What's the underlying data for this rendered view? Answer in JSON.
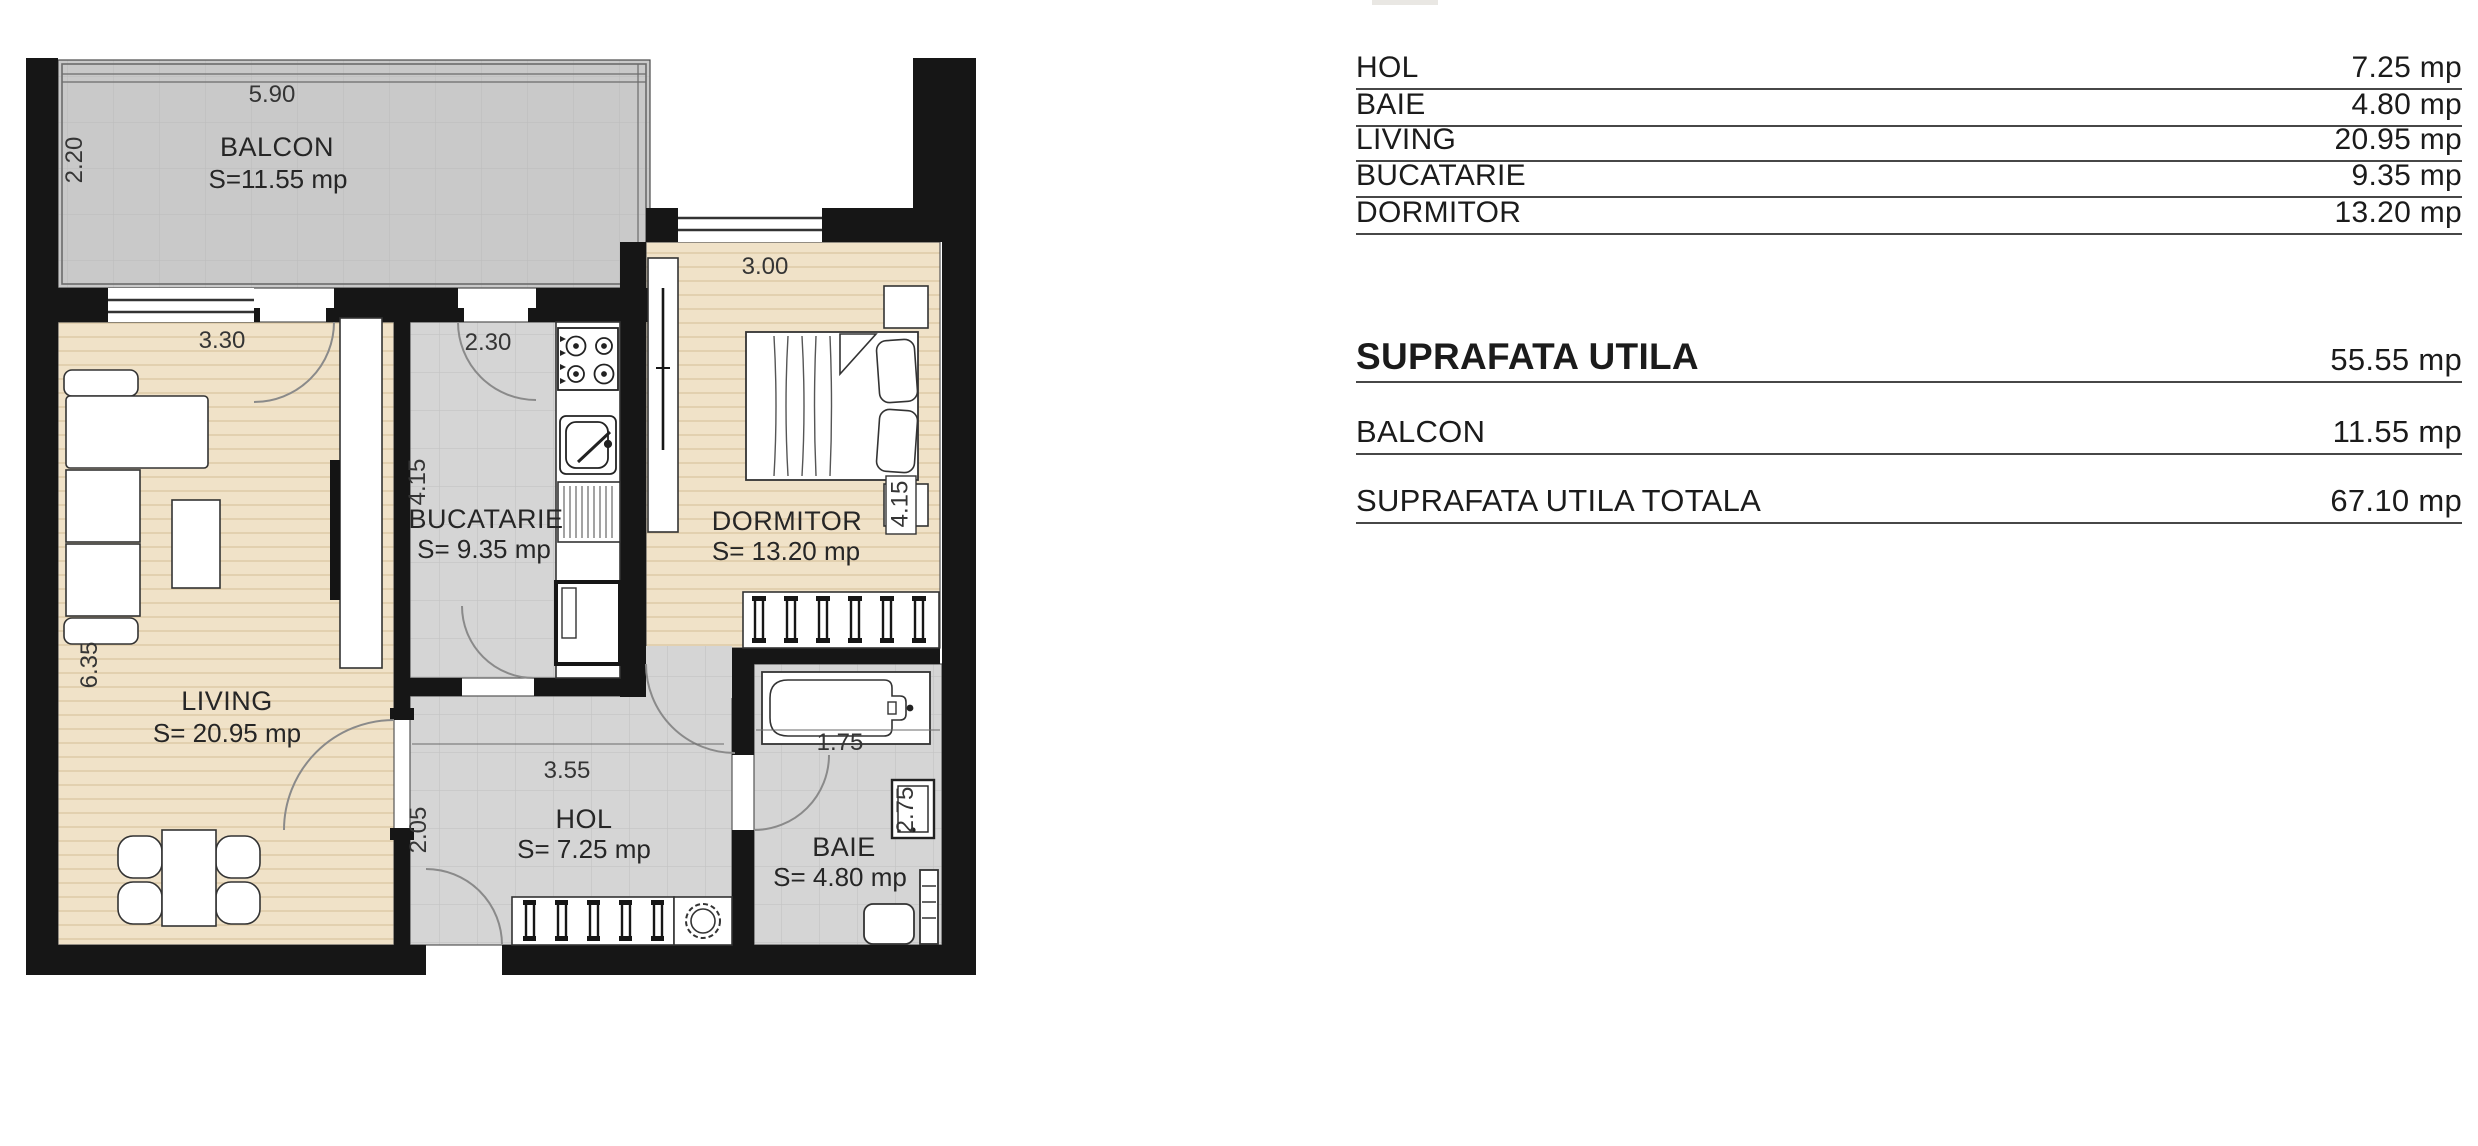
{
  "plan": {
    "rooms": {
      "balcon": {
        "name": "BALCON",
        "area": "S=11.55 mp",
        "dim_top": "5.90",
        "dim_left": "2.20"
      },
      "living": {
        "name": "LIVING",
        "area": "S= 20.95 mp",
        "dim_top": "3.30",
        "dim_left": "6.35"
      },
      "bucatarie": {
        "name": "BUCATARIE",
        "area": "S= 9.35 mp",
        "dim_top": "2.30",
        "dim_left": "4.15"
      },
      "dormitor": {
        "name": "DORMITOR",
        "area": "S= 13.20 mp",
        "dim_top": "3.00",
        "dim_right": "4.15"
      },
      "hol": {
        "name": "HOL",
        "area": "S= 7.25 mp",
        "dim_top": "3.55",
        "dim_left": "2.05"
      },
      "baie": {
        "name": "BAIE",
        "area": "S= 4.80 mp",
        "dim_top": "1.75",
        "dim_right": "2.75"
      }
    }
  },
  "table": {
    "rows": [
      {
        "label": "HOL",
        "value": "7.25 mp"
      },
      {
        "label": "BAIE",
        "value": "4.80 mp"
      },
      {
        "label": "LIVING",
        "value": "20.95 mp"
      },
      {
        "label": "BUCATARIE",
        "value": "9.35 mp"
      },
      {
        "label": "DORMITOR",
        "value": "13.20 mp"
      }
    ],
    "suprafata_utila": {
      "label": "SUPRAFATA UTILA",
      "value": "55.55 mp"
    },
    "balcon": {
      "label": "BALCON",
      "value": "11.55 mp"
    },
    "total": {
      "label": "SUPRAFATA UTILA TOTALA",
      "value": "67.10 mp"
    }
  },
  "colors": {
    "wall": "#161616",
    "wood": "#f0e2c8",
    "tile": "#d5d5d5",
    "balcony": "#c9c9c9"
  }
}
